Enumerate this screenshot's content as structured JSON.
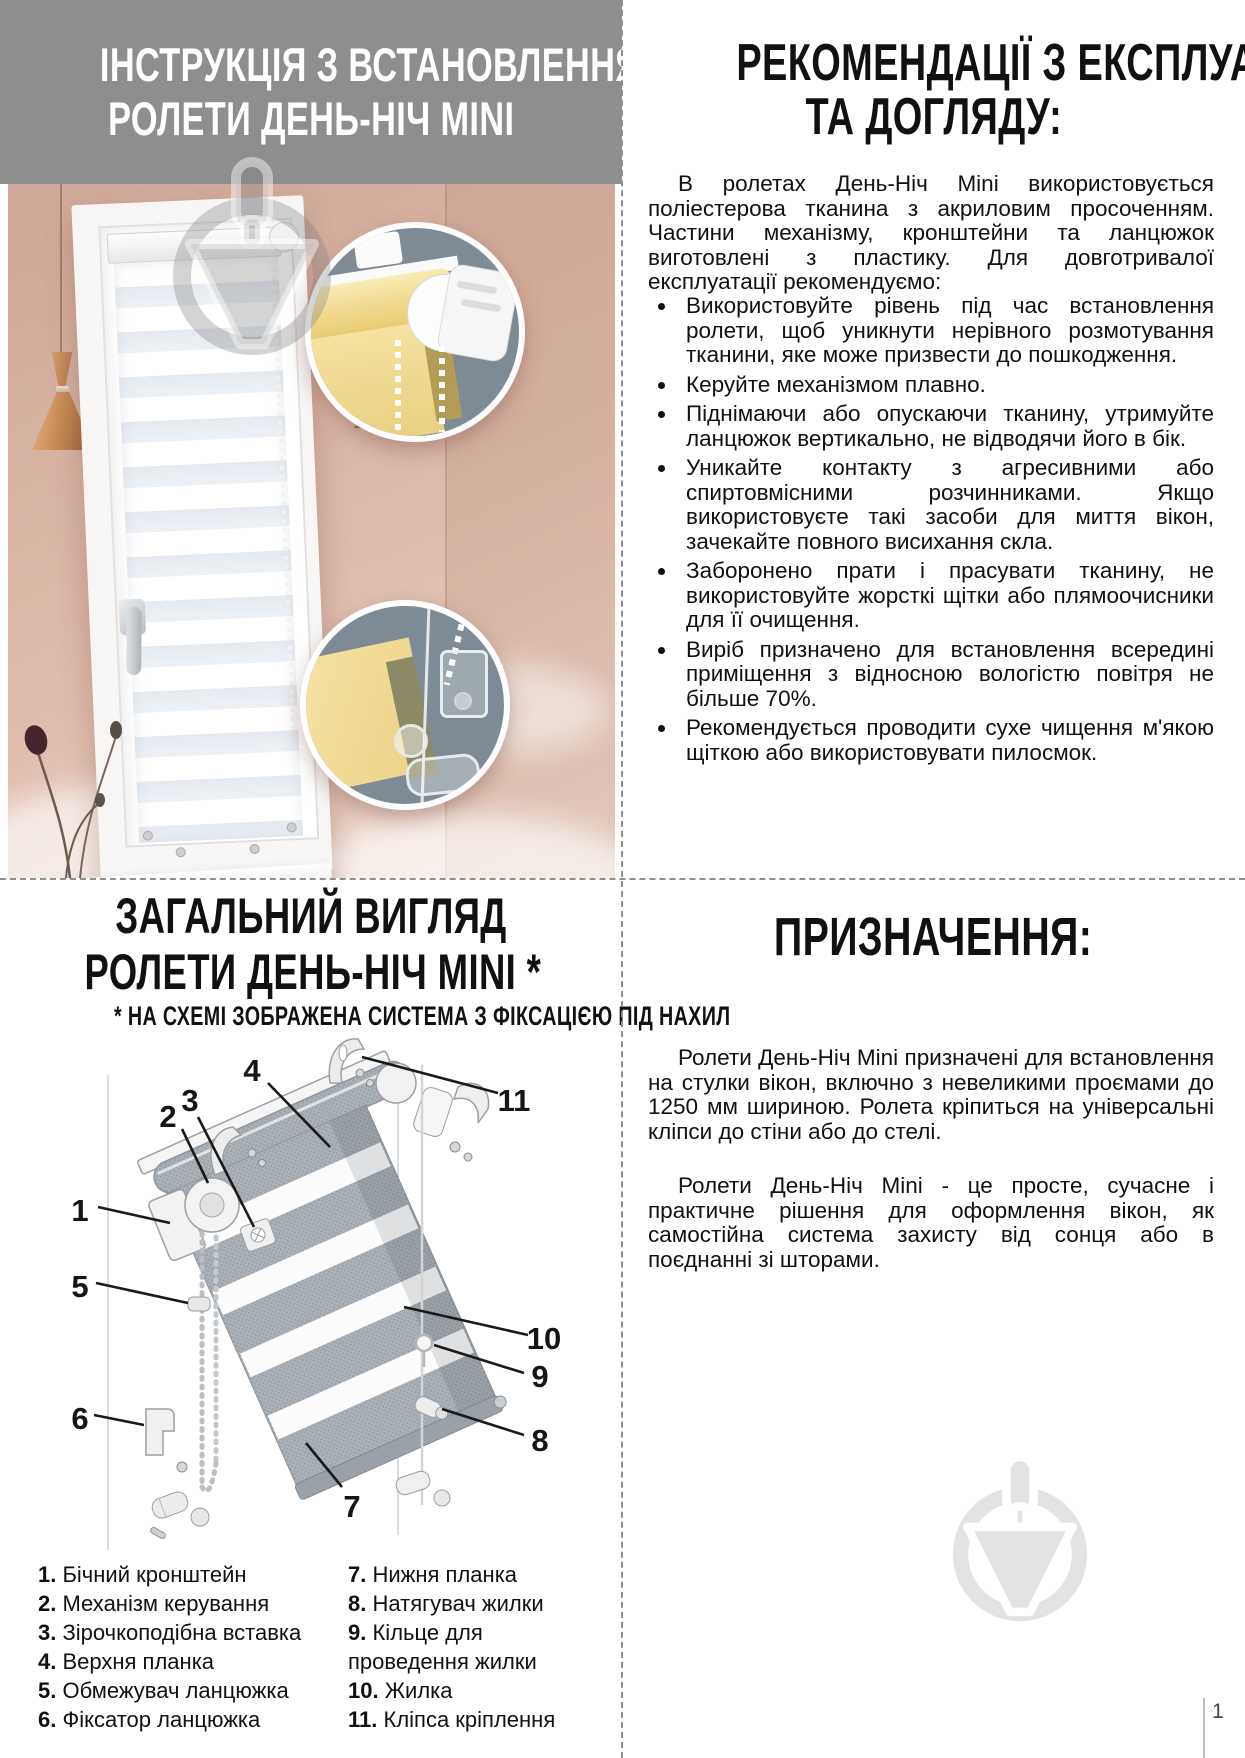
{
  "page": {
    "number": "1"
  },
  "colors": {
    "header_gray": "#8e8e8e",
    "wall_pink": "#dcb7a8",
    "inset_bg": "#7e8b95",
    "fabric_yellow": "#eed488",
    "copper": "#c3895a",
    "watermark_gray": "#e3e3e3",
    "text_black": "#111111"
  },
  "top_left": {
    "title_line1": "ІНСТРУКЦІЯ З ВСТАНОВЛЕННЯ",
    "title_line2": "РОЛЕТИ ДЕНЬ-НІЧ MINI"
  },
  "top_right": {
    "title_line1": "РЕКОМЕНДАЦІЇ З ЕКСПЛУАТАЦІЇ",
    "title_line2": "ТА ДОГЛЯДУ:",
    "intro": "В ролетах День-Ніч Mini використовується поліестерова тканина з акриловим просоченням. Частини механізму, кронштейни та ланцюжок виготовлені з пластику. Для довготривалої експлуатації рекомендуємо:",
    "bullets": [
      "Використовуйте рівень під час встановлення ролети, щоб уникнути нерівного розмотування тканини, яке може призвести до пошкодження.",
      "Керуйте механізмом плавно.",
      "Піднімаючи або опускаючи тканину, утримуйте ланцюжок вертикально, не відводячи його в бік.",
      "Уникайте контакту з агресивними або спиртовмісними розчинниками. Якщо використовуєте такі засоби для миття вікон, зачекайте повного висихання скла.",
      "Заборонено прати і прасувати тканину, не використовуйте жорсткі щітки або плямоочисники для її очищення.",
      "Виріб призначено для встановлення всередині приміщення з відносною вологістю повітря не більше 70%.",
      "Рекомендується проводити сухе чищення м'якою щіткою або використовувати пилосмок."
    ]
  },
  "bottom_left": {
    "title_line1": "ЗАГАЛЬНИЙ ВИГЛЯД",
    "title_line2": "РОЛЕТИ ДЕНЬ-НІЧ MINI *",
    "subtitle": "* НА СХЕМІ ЗОБРАЖЕНА СИСТЕМА З ФІКСАЦІЄЮ ПІД НАХИЛ",
    "callouts": [
      "1",
      "2",
      "3",
      "4",
      "5",
      "6",
      "7",
      "8",
      "9",
      "10",
      "11"
    ],
    "parts_left": [
      {
        "num": "1.",
        "label": "Бічний кронштейн"
      },
      {
        "num": "2.",
        "label": "Механізм керування"
      },
      {
        "num": "3.",
        "label": "Зірочкоподібна вставка"
      },
      {
        "num": "4.",
        "label": "Верхня планка"
      },
      {
        "num": "5.",
        "label": "Обмежувач ланцюжка"
      },
      {
        "num": "6.",
        "label": "Фіксатор ланцюжка"
      }
    ],
    "parts_right": [
      {
        "num": "7.",
        "label": "Нижня планка"
      },
      {
        "num": "8.",
        "label": "Натягувач жилки"
      },
      {
        "num": "9.",
        "label": "Кільце для проведення жилки"
      },
      {
        "num": "10.",
        "label": "Жилка"
      },
      {
        "num": "11.",
        "label": "Кліпса кріплення"
      }
    ]
  },
  "bottom_right": {
    "title": "ПРИЗНАЧЕННЯ:",
    "para1": "Ролети День-Ніч Mini призначені для встановлення на стулки вікон, включно з невеликими проємами до 1250 мм шириною. Ролета кріпиться на універсальні кліпси до стіни або до стелі.",
    "para2": "Ролети День-Ніч Mini - це просте, сучасне і практичне рішення для оформлення вікон, як самостійна система захисту від сонця або в поєднанні зі шторами."
  }
}
